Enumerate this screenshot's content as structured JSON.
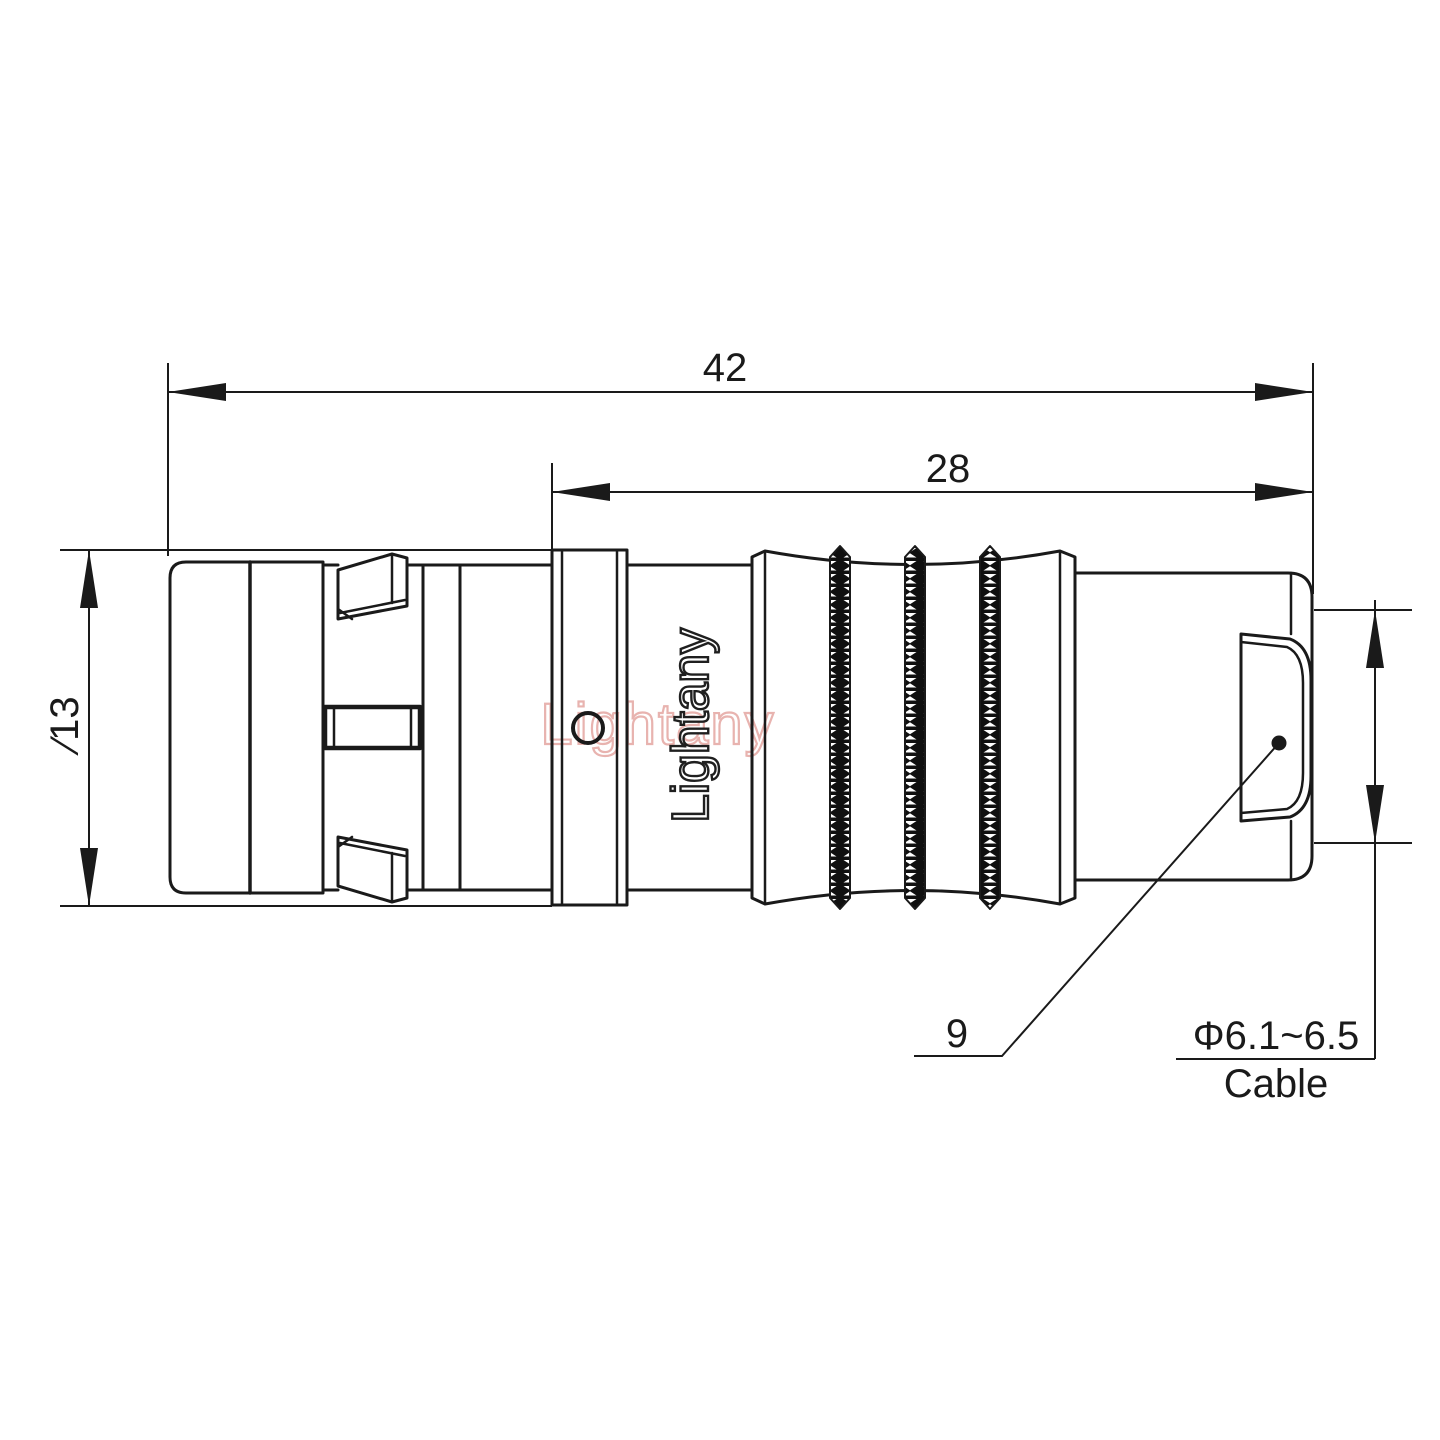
{
  "drawing": {
    "title": "connector-outline-drawing",
    "line_color": "#1a1a1a",
    "background": "#ffffff",
    "dimensions": {
      "overall_length": "42",
      "front_length": "28",
      "outer_diameter": "∕13",
      "leader_label": "9",
      "cable_note_line1": "Φ6.1~6.5",
      "cable_note_line2": "Cable"
    },
    "watermark": {
      "text": "Lightany",
      "color": "#e8b3af"
    },
    "brand": {
      "text": "Lightany",
      "color": "#1f1f1f"
    }
  }
}
